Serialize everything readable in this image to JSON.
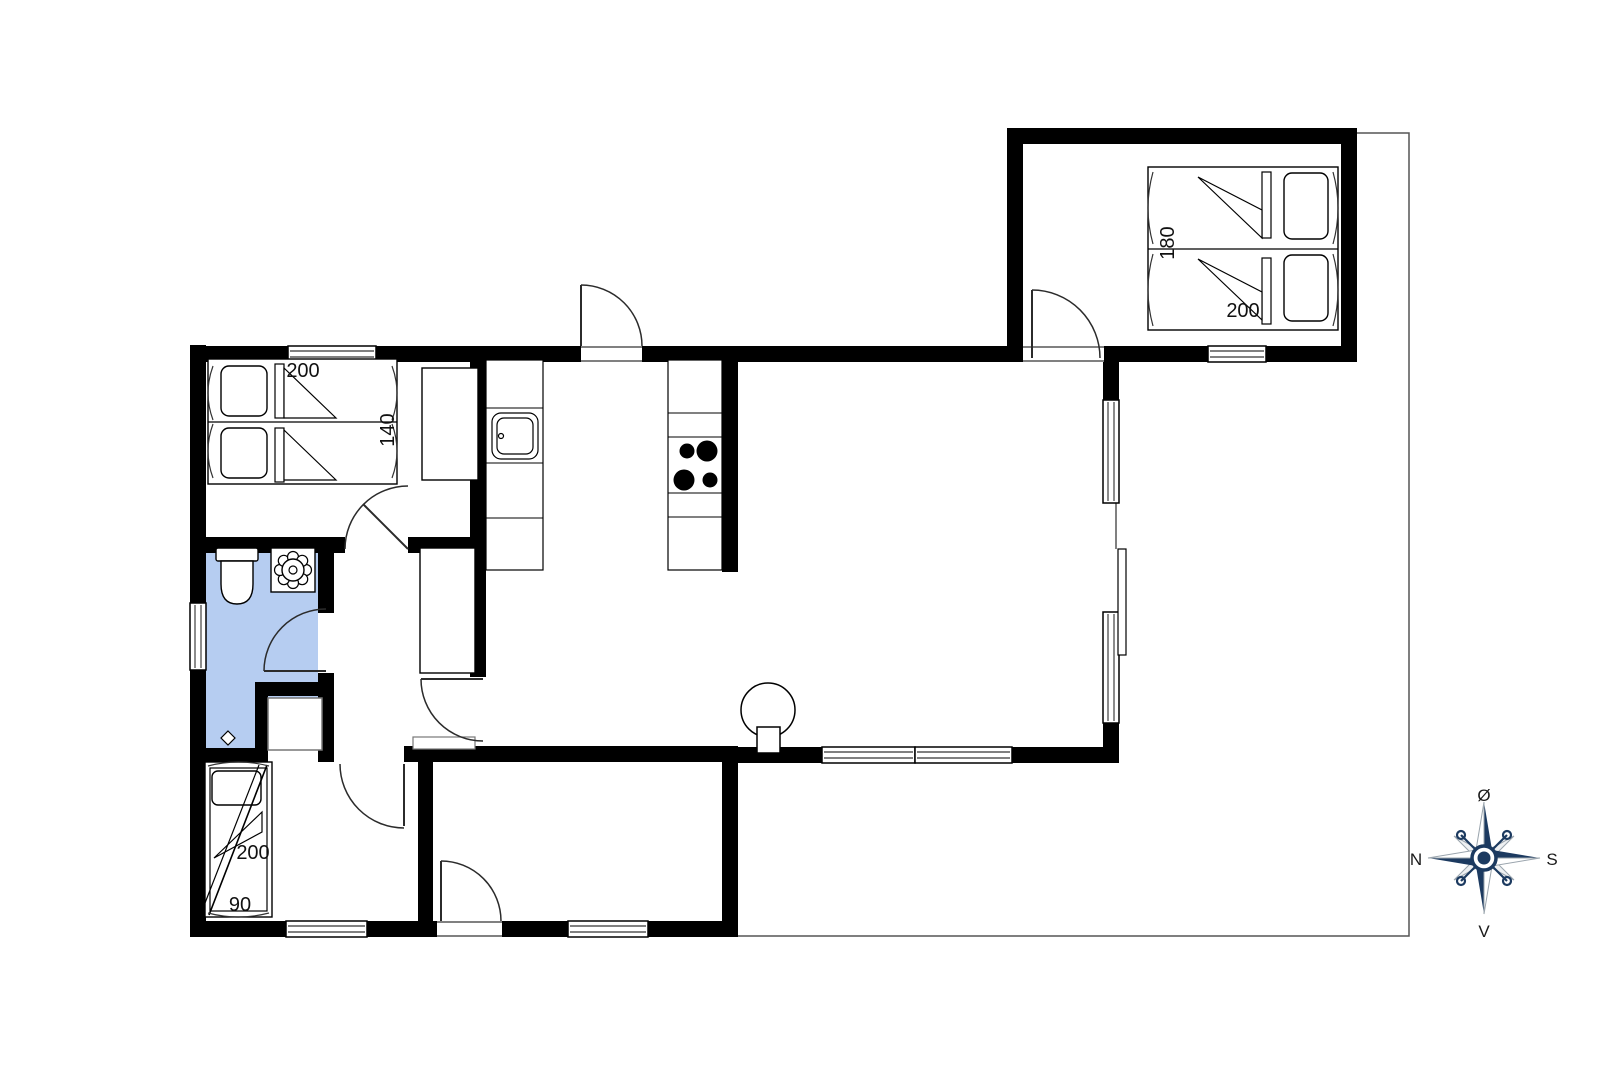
{
  "labels": {
    "bedroom_left_bed_length": "200",
    "bedroom_left_bed_width": "140",
    "bedroom_top_right_bed_width": "180",
    "bedroom_top_right_bed_length": "200",
    "bedroom_bottom_bed_length": "200",
    "bedroom_bottom_bed_width": "90"
  },
  "compass": {
    "top": "Ø",
    "right": "S",
    "bottom": "V",
    "left": "N"
  },
  "colors": {
    "wall": "#000000",
    "bathroom_floor": "#b6cdf1",
    "compass_navy": "#1c3a60",
    "terrace_outline": "#555555"
  }
}
